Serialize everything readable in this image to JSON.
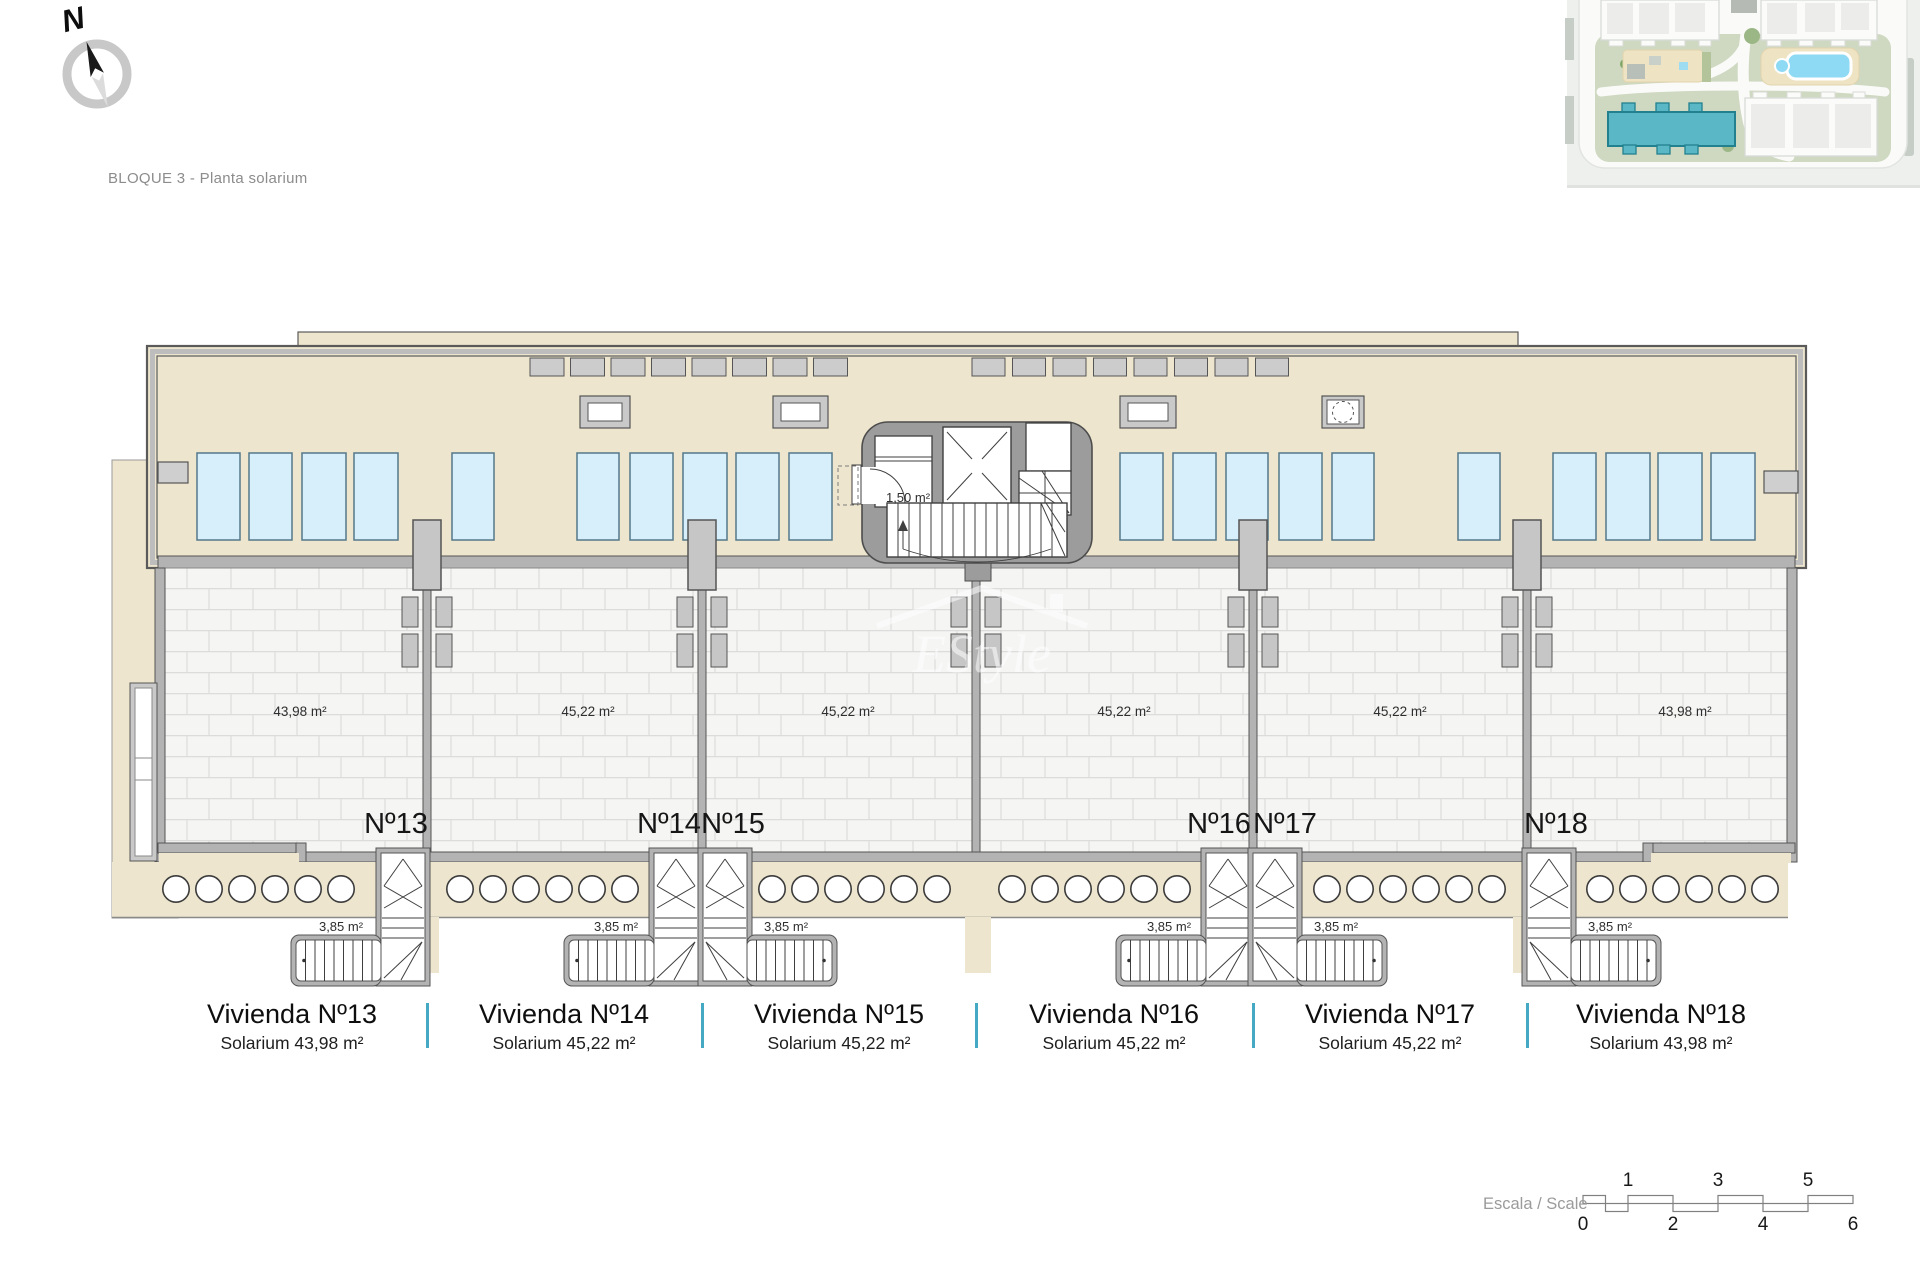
{
  "page": {
    "title": "BLOQUE 3 - Planta solarium"
  },
  "compass": {
    "label": "N"
  },
  "site_inset": {
    "highlighted_block_color": "#5ab7c5"
  },
  "plan": {
    "stairwell_area": "1,50 m²",
    "colors": {
      "deck_beige": "#ede5cd",
      "panel_blue": "#d6effa",
      "wall_gray": "#b3b3b3",
      "accent_teal": "#45a9c4"
    },
    "units": [
      {
        "id": "13",
        "numero": "Nº13",
        "area": "43,98 m²",
        "stair_area": "3,85 m²",
        "vivienda": "Vivienda Nº13",
        "solarium": "Solarium 43,98 m²"
      },
      {
        "id": "14",
        "numero": "Nº14",
        "area": "45,22 m²",
        "stair_area": "3,85 m²",
        "vivienda": "Vivienda Nº14",
        "solarium": "Solarium 45,22 m²"
      },
      {
        "id": "15",
        "numero": "Nº15",
        "area": "45,22 m²",
        "stair_area": "3,85 m²",
        "vivienda": "Vivienda Nº15",
        "solarium": "Solarium 45,22 m²"
      },
      {
        "id": "16",
        "numero": "Nº16",
        "area": "45,22 m²",
        "stair_area": "3,85 m²",
        "vivienda": "Vivienda Nº16",
        "solarium": "Solarium 45,22 m²"
      },
      {
        "id": "17",
        "numero": "Nº17",
        "area": "45,22 m²",
        "stair_area": "3,85 m²",
        "vivienda": "Vivienda Nº17",
        "solarium": "Solarium 45,22 m²"
      },
      {
        "id": "18",
        "numero": "Nº18",
        "area": "43,98 m²",
        "stair_area": "3,85 m²",
        "vivienda": "Vivienda Nº18",
        "solarium": "Solarium 43,98 m²"
      }
    ]
  },
  "scale_bar": {
    "label": "Escala / Scale",
    "top_ticks": [
      "1",
      "3",
      "5"
    ],
    "bottom_ticks": [
      "0",
      "2",
      "4",
      "6"
    ]
  },
  "watermark": {
    "text": "EStyle"
  }
}
